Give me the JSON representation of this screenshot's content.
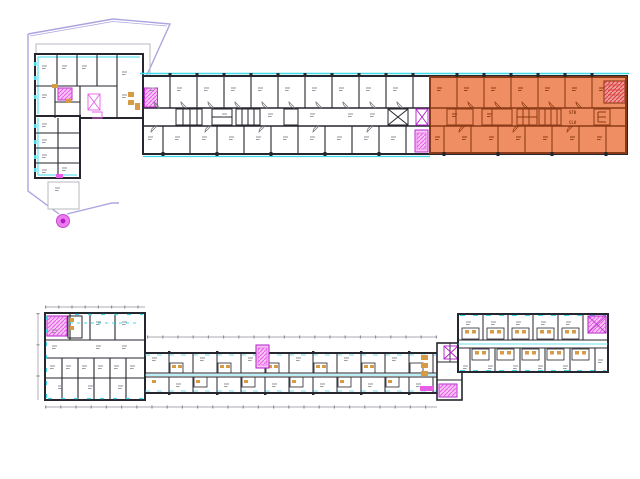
{
  "document": {
    "type": "cad-floor-plan-drawing",
    "background": "#ffffff",
    "plan_count": 2
  },
  "colors": {
    "background": "#ffffff",
    "wall": "#26262e",
    "site_gray": "#b8b8c2",
    "cyan": "#3fd9e8",
    "lavender": "#aba5de",
    "magenta": "#e85ce8",
    "magenta_dark": "#b21cc8",
    "magenta_light": "#f7c2f4",
    "orange_fill": "#f08e63",
    "orange_wall": "#8a3a16",
    "red_stair": "#ee9a96",
    "red_hatch": "#d83c3c",
    "tan": "#d79a45",
    "dim": "#8f8f9a",
    "label": "#8f909a",
    "door": "#6a6a74"
  },
  "plans": {
    "upper": {
      "name": "Upper floor plan",
      "highlight": "orange highlighted east wing",
      "core_labels": {
        "stb": "STB",
        "clo": "CLO"
      }
    },
    "lower": {
      "name": "Lower floor plan"
    }
  },
  "markers": {
    "site_pin": "magenta site pin at boundary apex"
  }
}
